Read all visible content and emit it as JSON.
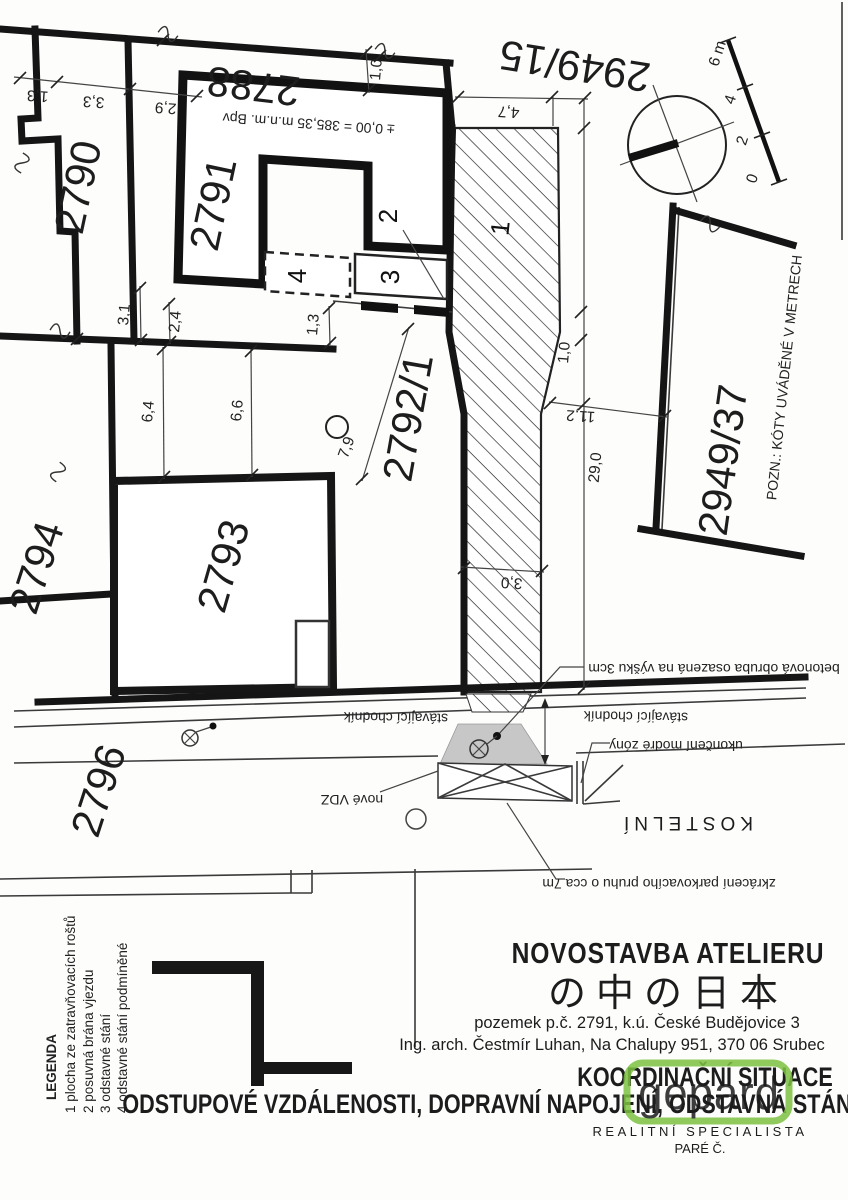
{
  "parcels": {
    "p2788": "2788",
    "p2790": "2790",
    "p2791": "2791",
    "p2792_1": "2792/1",
    "p2793": "2793",
    "p2794": "2794",
    "p2796": "2796",
    "p2949_15": "2949/15",
    "p2949_37": "2949/37"
  },
  "zones": {
    "z1": "1",
    "z2": "2",
    "z3": "3",
    "z4": "4"
  },
  "dimensions": {
    "d13a": "1,3",
    "d33": "3,3",
    "d29": "2,9",
    "d10top": "1,0",
    "d47": "4,7",
    "d31": "3,1",
    "d24": "2,4",
    "d13b": "1,3",
    "d64": "6,4",
    "d66": "6,6",
    "d79": "7,9",
    "d10r": "1,0",
    "d112": "11,2",
    "d290": "29,0",
    "d30": "3,0"
  },
  "scalebar": {
    "s0": "0",
    "s2": "2",
    "s4": "4",
    "s6": "6 m"
  },
  "notes": {
    "pozn": "POZN.: KÓTY UVÁDĚNÉ V METRECH",
    "bpv": "± 0,00 = 385,35 m.n.m. Bpv"
  },
  "annotations": {
    "obruba": "betonová obruba osazená na výšku 3cm",
    "chodnik1": "stávající chodník",
    "chodnik2": "stávající chodník",
    "zona": "ukončení modré zóny",
    "vdz": "nové VDZ",
    "street": "KOSTELNÍ",
    "zkraceni": "zkrácení parkovacího pruhu o cca 7m"
  },
  "legend": {
    "title": "LEGENDA",
    "items": [
      "1 plocha ze zatravňovacích roštů",
      "2 posuvná brána vjezdu",
      "3 odstavné stání",
      "4 odstavné stání podmíněné"
    ]
  },
  "titleblock": {
    "project": "NOVOSTAVBA ATELIERU",
    "project_jp": "の中の日本",
    "parcel_info": "pozemek p.č. 2791, k.ú. České Budějovice 3",
    "architect": "Ing. arch. Čestmír Luhan, Na Chalupy 951, 370 06 Srubec",
    "drawing_title": "KOORDINAČNÍ SITUACE",
    "drawing_subtitle": "ODSTUPOVÉ VZDÁLENOSTI, DOPRAVNÍ NAPOJENÍ, ODSTAVNÁ STÁNÍ",
    "pare": "PARÉ Č."
  },
  "watermark": {
    "brand": "gepard",
    "tagline": "REALITNÍ SPECIALISTA",
    "color": "#7dc242"
  },
  "colors": {
    "watermark_green": "#7dc242",
    "street_name_gray": "#b3b3b3",
    "driveway_gray": "#c7c7c7"
  }
}
